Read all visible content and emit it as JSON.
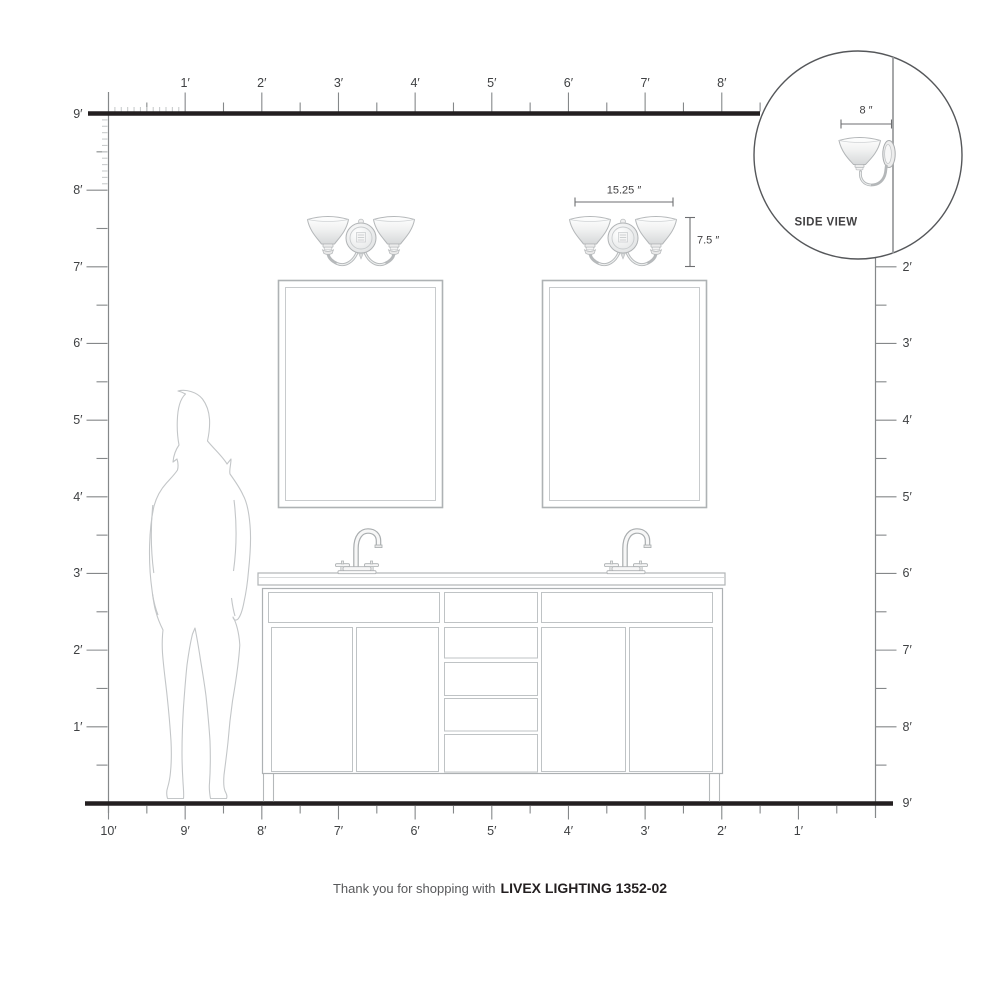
{
  "title": "Scale installation diagram for a two-light bath vanity fixture",
  "rulers": {
    "unit": "feet",
    "top_labels": [
      "1′",
      "2′",
      "3′",
      "4′",
      "5′",
      "6′",
      "7′",
      "8′"
    ],
    "left_labels": [
      "9′",
      "8′",
      "7′",
      "6′",
      "5′",
      "4′",
      "3′",
      "2′",
      "1′"
    ],
    "right_labels": [
      "2′",
      "3′",
      "4′",
      "5′",
      "6′",
      "7′",
      "8′",
      "9′"
    ],
    "bottom_labels": [
      "10′",
      "9′",
      "8′",
      "7′",
      "6′",
      "5′",
      "4′",
      "3′",
      "2′",
      "1′"
    ]
  },
  "fixture_dimensions": {
    "width": "15.25 ″",
    "height": "7.5 ″"
  },
  "inset": {
    "label": "SIDE VIEW",
    "width_dimension": "8 ″"
  },
  "footer": {
    "prefix": "Thank you for shopping with",
    "product": "LIVEX LIGHTING 1352-02"
  },
  "colors": {
    "ink": "#231f20",
    "ruler_line": "#85888a",
    "label_text": "#3f4143",
    "line_art": "#b7babc",
    "dimension_line": "#6d6e71"
  }
}
